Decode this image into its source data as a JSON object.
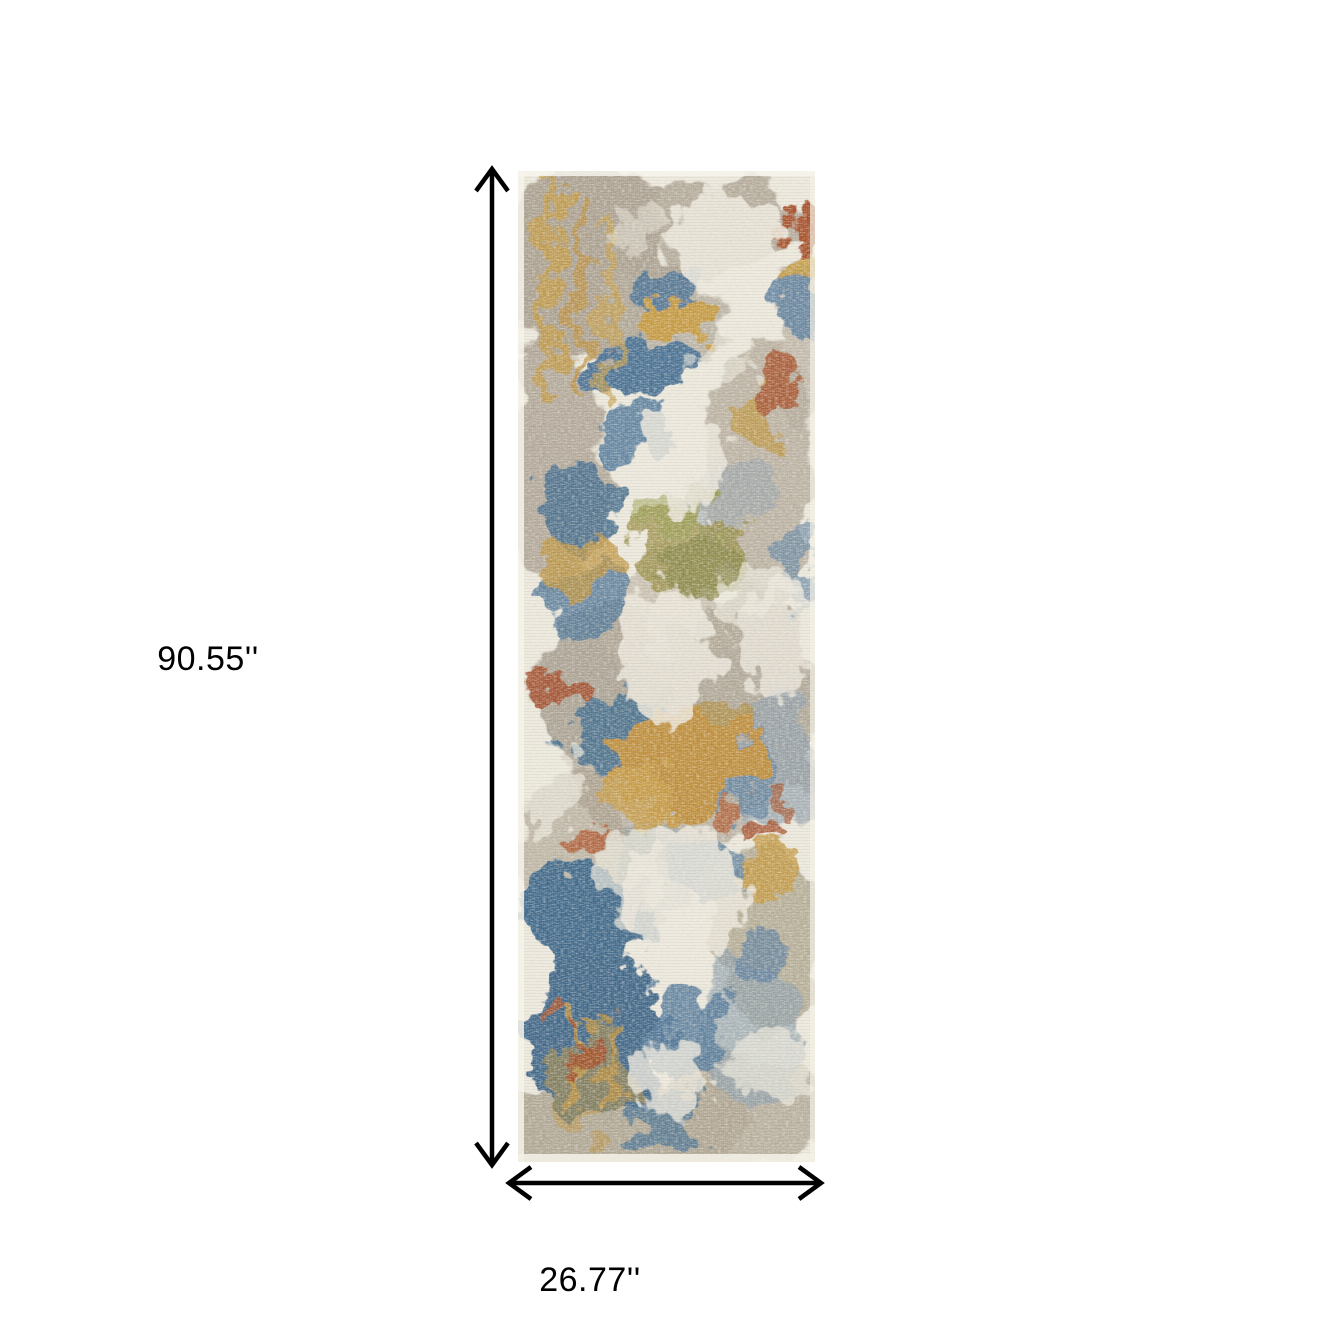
{
  "canvas": {
    "background": "#ffffff"
  },
  "annotations": {
    "height_label": "90.55''",
    "width_label": "26.77''",
    "arrow_color": "#000000"
  },
  "rug_photo": {
    "content": "abstract distressed multicolor runner rug",
    "palette": {
      "ivory": "#ede9dd",
      "taupe": "#aea493",
      "gray_blue": "#90a1ad",
      "blue": "#47708f",
      "gold": "#c2973e",
      "olive": "#8c8a4a",
      "rust": "#a8542c"
    }
  }
}
